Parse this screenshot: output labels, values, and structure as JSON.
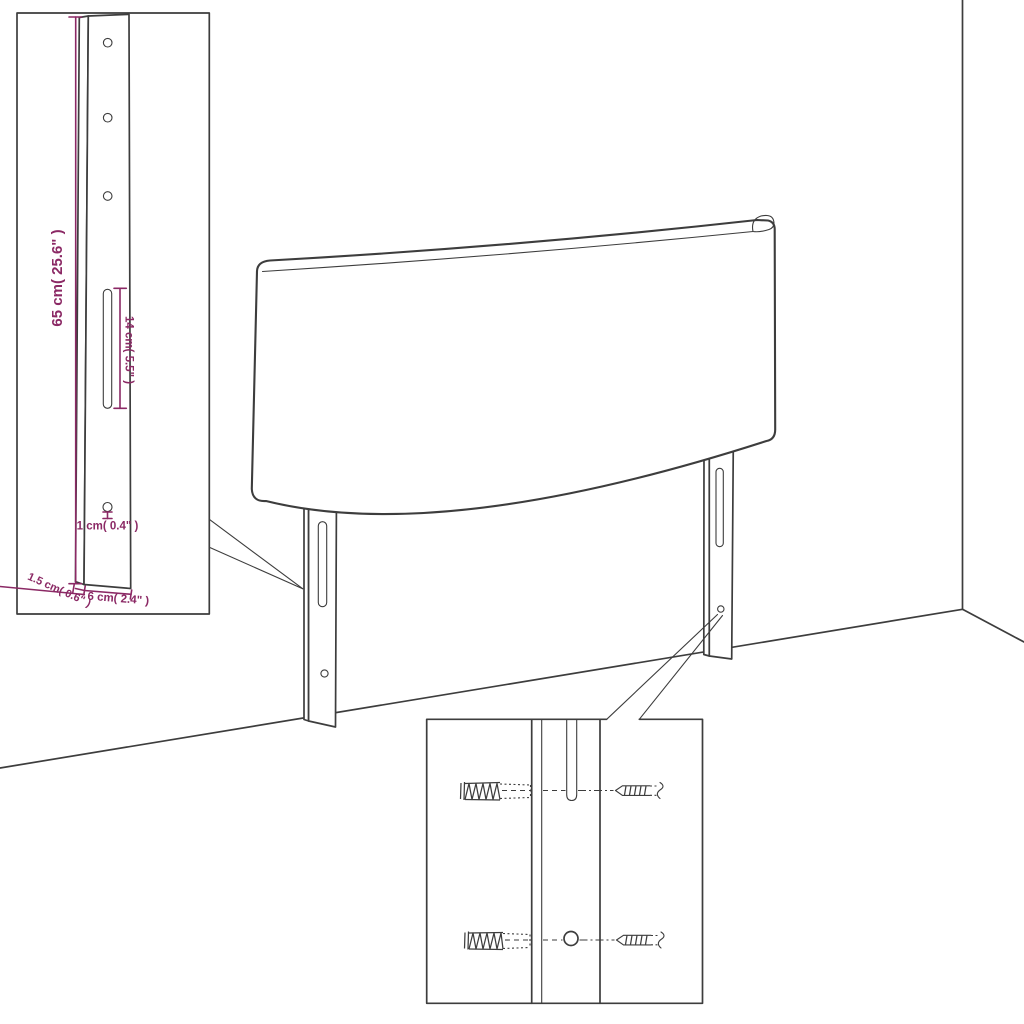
{
  "figure": {
    "type": "furniture-assembly-diagram",
    "subject": "headboard with two wall-mount leg brackets, dimension detail inset and screw/wall-plug detail inset",
    "colors": {
      "background": "#ffffff",
      "line": "#3d3d3d",
      "dimension": "#8b2965"
    },
    "detail_inset": {
      "height_label": "65 cm( 25.6\" )",
      "slot_label": "14 cm( 5.5\" )",
      "hole_label": "1 cm( 0.4\" )",
      "thickness_label": "1.5 cm( 0.6\" )",
      "width_label": "6 cm( 2.4\" )"
    },
    "hardware_inset": {
      "items": [
        "wall-plug",
        "screw",
        "leg-slot",
        "leg-hole"
      ]
    }
  }
}
